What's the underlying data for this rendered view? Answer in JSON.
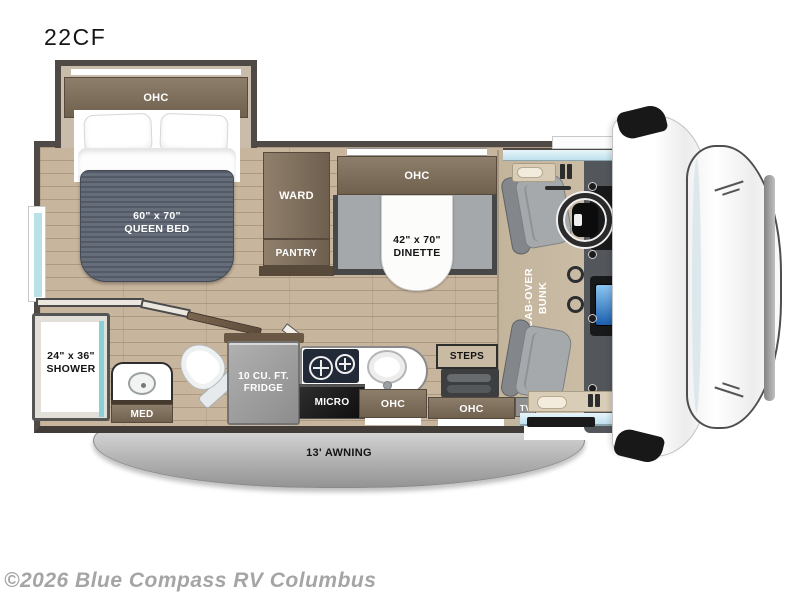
{
  "title": "22CF",
  "watermark": "©2026 Blue Compass RV Columbus",
  "bedroom": {
    "ohc": "OHC",
    "bed_size": "60\" x 70\"",
    "bed_name": "QUEEN BED"
  },
  "bathroom": {
    "shower_size": "24\" x 36\"",
    "shower_name": "SHOWER",
    "med": "MED"
  },
  "kitchen": {
    "fridge_size": "10 CU. FT.",
    "fridge_name": "FRIDGE",
    "micro": "MICRO",
    "ohc": "OHC"
  },
  "living": {
    "ward": "WARD",
    "pantry": "PANTRY",
    "ohc": "OHC",
    "dinette_size": "42\" x 70\"",
    "dinette_name": "DINETTE"
  },
  "entry": {
    "steps": "STEPS",
    "ohc": "OHC",
    "tv": "TV"
  },
  "cab": {
    "bunk_line1": "CAB-OVER",
    "bunk_line2": "BUNK"
  },
  "exterior": {
    "awning": "13' AWNING"
  },
  "colors": {
    "cabinet_brown": "#7d6e5c",
    "floor_tan": "#c8b59d",
    "wall_gray": "#4f4a45",
    "mattress_gray": "#5c6370",
    "bench_gray": "#a4a8aa",
    "shower_glass_teal": "#86d2d8",
    "windshield_blue": "#cfe9f2",
    "awning_gray": "#b9b9b9",
    "bunk_tan": "#c6b8a2"
  }
}
